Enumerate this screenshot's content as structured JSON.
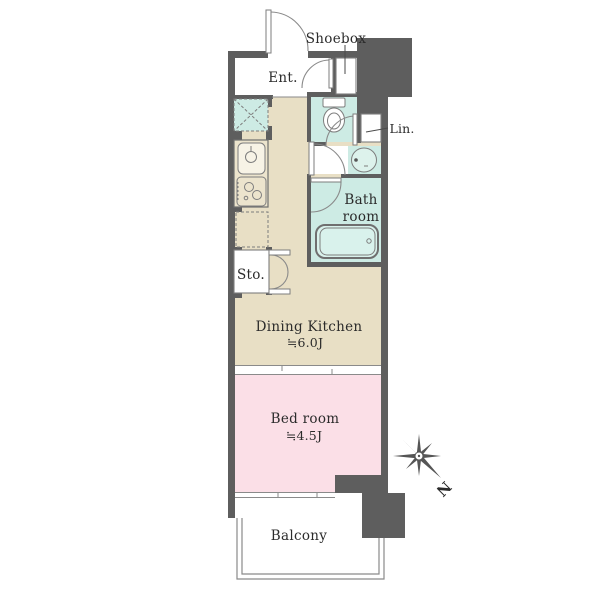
{
  "plan": {
    "type": "apartment-floor-plan",
    "units": "J (jou / tatami mats)"
  },
  "colors": {
    "wall": "#5e5e5e",
    "dining_kitchen": "#e8dfc5",
    "bedroom": "#fbdfe7",
    "wet_area": "#cdebe4",
    "fixture_fill": "#ffffff",
    "outline": "#8a8a8a",
    "text": "#2b2b2b",
    "background": "#ffffff"
  },
  "rooms": {
    "shoebox": {
      "label": "Shoebox"
    },
    "entrance": {
      "label": "Ent."
    },
    "linen": {
      "label": "Lin."
    },
    "bathroom": {
      "label_line1": "Bath",
      "label_line2": "room"
    },
    "storage": {
      "label": "Sto."
    },
    "dining_kitchen": {
      "label": "Dining Kitchen",
      "size": "≒6.0J"
    },
    "bedroom": {
      "label": "Bed room",
      "size": "≒4.5J"
    },
    "balcony": {
      "label": "Balcony"
    }
  },
  "compass": {
    "label": "N",
    "direction": "north points lower-right"
  }
}
